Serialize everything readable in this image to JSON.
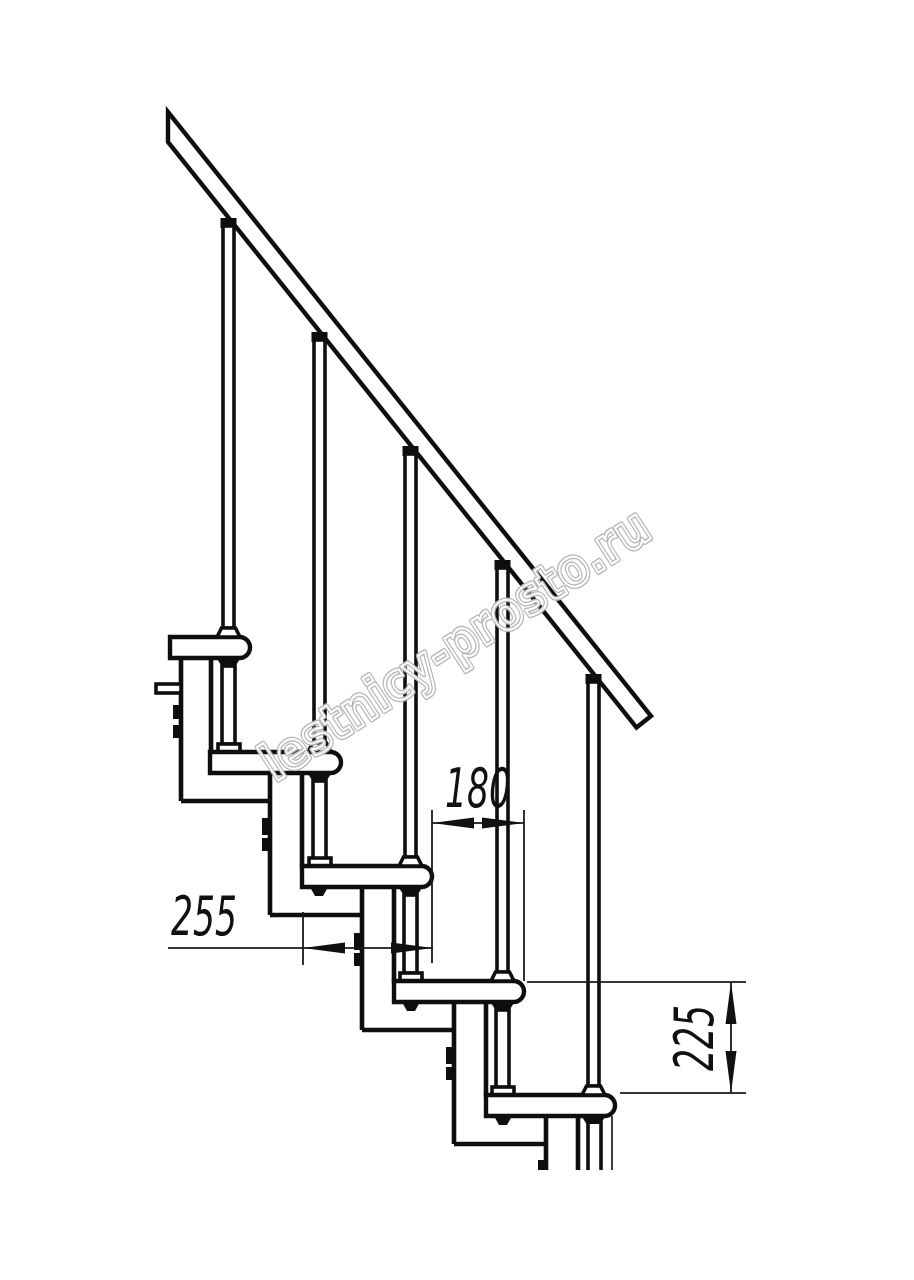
{
  "drawing": {
    "title": "Modular staircase side elevation drawing",
    "watermark": {
      "text": "lestnicy-prosto.ru"
    },
    "dimensions": {
      "step_run": "180",
      "tread_depth": "255",
      "step_rise": "225"
    }
  }
}
